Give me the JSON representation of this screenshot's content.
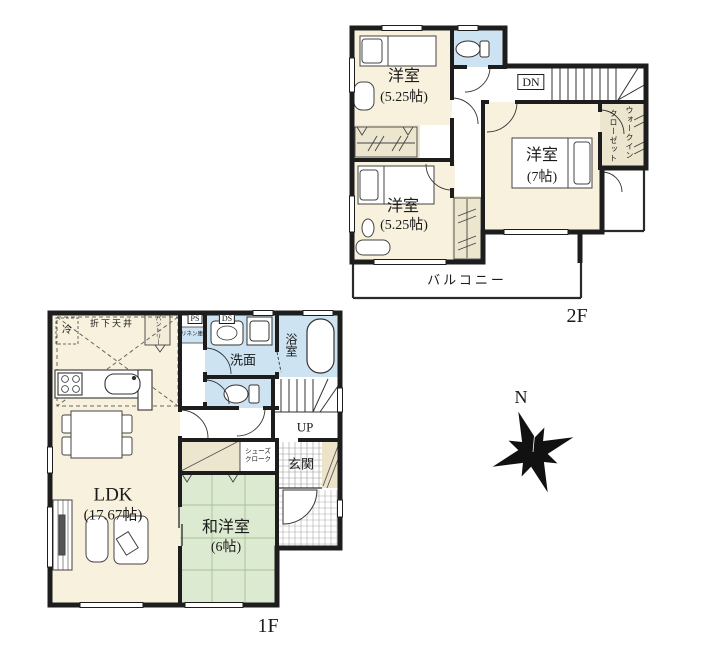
{
  "floor2": {
    "label": "2F",
    "rooms": {
      "bedroom1": {
        "name": "洋室",
        "size": "(5.25帖)"
      },
      "bedroom2": {
        "name": "洋室",
        "size": "(5.25帖)"
      },
      "bedroom3": {
        "name": "洋室",
        "size": "(7帖)"
      },
      "walk_in_closet_line1": "ウォークイン",
      "walk_in_closet_line2": "クローゼット",
      "stairs_down": "DN",
      "balcony": "バルコニー"
    }
  },
  "floor1": {
    "label": "1F",
    "rooms": {
      "ldk": {
        "name": "LDK",
        "size": "(17.67帖)"
      },
      "japanese_room": {
        "name": "和洋室",
        "size": "(6帖)"
      },
      "washroom": "洗面",
      "bathroom": "浴室",
      "entrance": "玄関",
      "shoe_closet_line1": "シューズ",
      "shoe_closet_line2": "クローク",
      "pantry": "パントリー",
      "linen_closet": "リネン庫",
      "pipe_space": "PS",
      "duct_space": "DS",
      "refrigerator": "冷",
      "lowered_ceiling": "折下天井",
      "stairs_up": "UP"
    }
  },
  "compass": {
    "north": "N"
  },
  "colors": {
    "wall": "#1d1d1d",
    "room_cream": "#f8f1de",
    "tatami_green": "#dcead2",
    "wet_area_blue": "#cde3f2",
    "closet_beige": "#ede6cf"
  }
}
